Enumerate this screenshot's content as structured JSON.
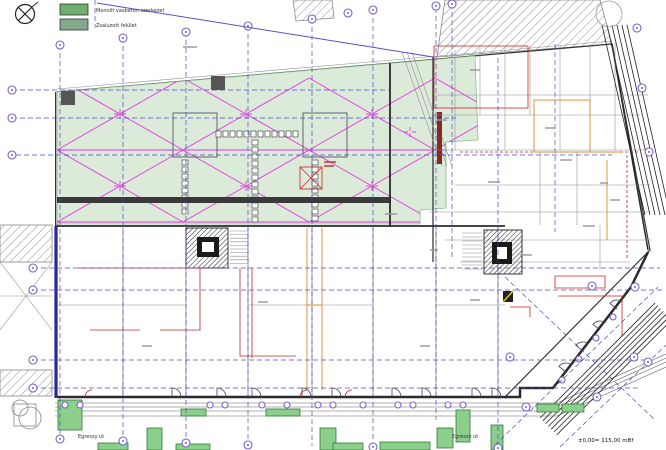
{
  "plan": {
    "legend": {
      "items": [
        {
          "label": "Monolit vasbeton szerkezet"
        },
        {
          "label": "Zsaluzott felület"
        }
      ]
    },
    "streets": {
      "left": "Egressy út",
      "right": "Egressy út"
    },
    "datum": "±0,00= 115,00 mBf"
  },
  "colors": {
    "green_zone": "#dcebd9",
    "green_zone_border": "#8bbf8b",
    "legend_green_1": "#6fae6f",
    "legend_green_2": "#85a88b",
    "magenta": "#e23ae0",
    "grid_blue": "#4444bb",
    "bubble": "#7a5fd0",
    "wall": "#2b2b2b",
    "red": "#cc2424",
    "orange": "#e0872e",
    "planter_fill": "#8ccf8c",
    "planter_border": "#2f7d34",
    "track": "#222222",
    "property_blue": "#2626b4"
  }
}
